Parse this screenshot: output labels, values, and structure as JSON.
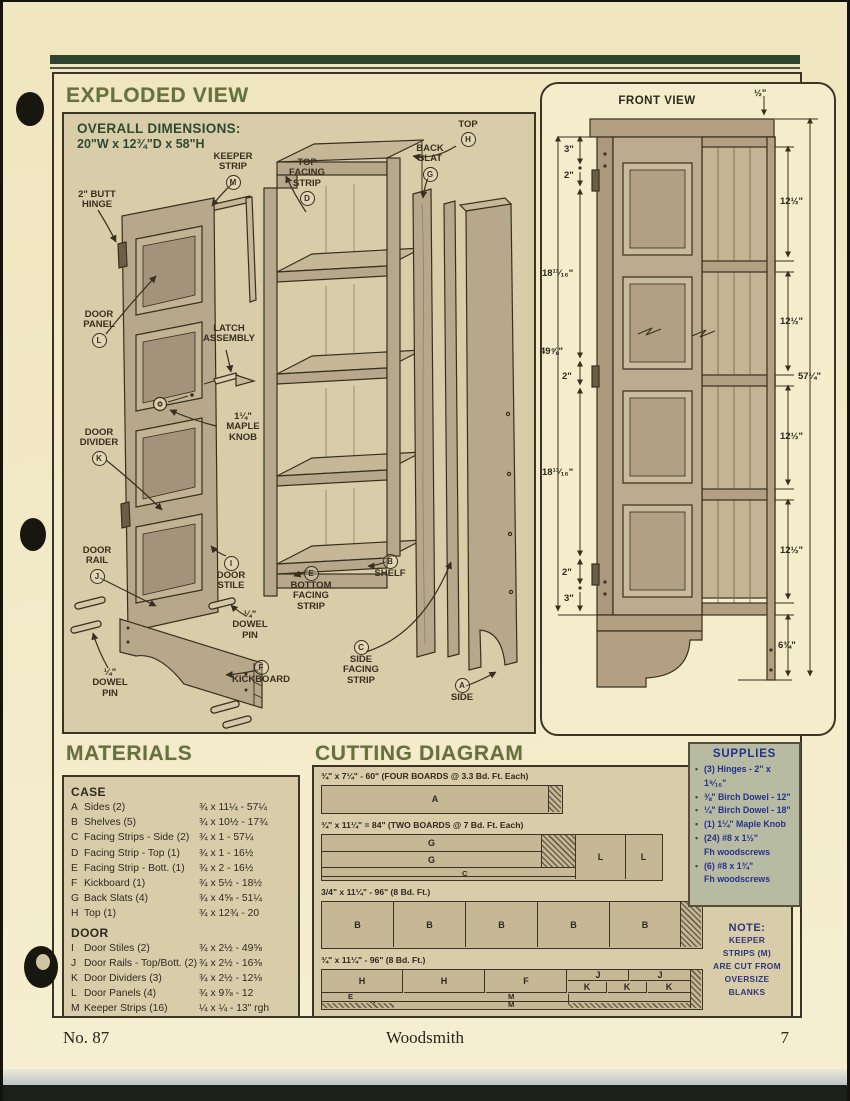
{
  "header": {
    "exploded_title": "EXPLODED VIEW"
  },
  "exploded": {
    "overall1": "OVERALL DIMENSIONS:",
    "overall2": "20\"W x 12¾\"D x 58\"H",
    "labels": [
      {
        "lines": [
          "TOP"
        ],
        "letter": "H",
        "lp": "below",
        "x": 376,
        "y": 6,
        "w": 56
      },
      {
        "lines": [
          "BACK",
          "SLAT"
        ],
        "letter": "G",
        "lp": "below",
        "x": 336,
        "y": 30,
        "w": 60
      },
      {
        "lines": [
          "KEEPER",
          "STRIP"
        ],
        "letter": "M",
        "lp": "below",
        "x": 134,
        "y": 38,
        "w": 70
      },
      {
        "lines": [
          "TOP",
          "FACING",
          "STRIP"
        ],
        "letter": "D",
        "lp": "below",
        "x": 210,
        "y": 44,
        "w": 66
      },
      {
        "lines": [
          "2\" BUTT",
          "HINGE"
        ],
        "x": 4,
        "y": 76,
        "w": 58
      },
      {
        "lines": [
          "DOOR",
          "PANEL"
        ],
        "letter": "L",
        "lp": "below",
        "x": 6,
        "y": 196,
        "w": 58
      },
      {
        "lines": [
          "LATCH",
          "ASSEMBLY"
        ],
        "x": 126,
        "y": 210,
        "w": 78
      },
      {
        "lines": [
          "1¼\"",
          "MAPLE",
          "KNOB"
        ],
        "x": 150,
        "y": 298,
        "w": 58
      },
      {
        "lines": [
          "DOOR",
          "DIVIDER"
        ],
        "letter": "K",
        "lp": "below",
        "x": 2,
        "y": 314,
        "w": 66
      },
      {
        "lines": [
          "DOOR",
          "RAIL"
        ],
        "letter": "J",
        "lp": "below",
        "x": 6,
        "y": 432,
        "w": 54
      },
      {
        "lines": [
          "DOOR",
          "STILE"
        ],
        "letter": "I",
        "lp": "above",
        "x": 138,
        "y": 440,
        "w": 58
      },
      {
        "lines": [
          "¼\"",
          "DOWEL",
          "PIN"
        ],
        "x": 160,
        "y": 496,
        "w": 52
      },
      {
        "lines": [
          "SHELF"
        ],
        "letter": "B",
        "lp": "above",
        "x": 298,
        "y": 438,
        "w": 56
      },
      {
        "lines": [
          "BOTTOM",
          "FACING",
          "STRIP"
        ],
        "letter": "E",
        "lp": "above",
        "x": 214,
        "y": 450,
        "w": 66
      },
      {
        "lines": [
          "KICKBOARD"
        ],
        "letter": "F",
        "lp": "above",
        "x": 152,
        "y": 544,
        "w": 90
      },
      {
        "lines": [
          "¼\"",
          "DOWEL",
          "PIN"
        ],
        "x": 20,
        "y": 554,
        "w": 52
      },
      {
        "lines": [
          "SIDE",
          "FACING",
          "STRIP"
        ],
        "letter": "C",
        "lp": "above",
        "x": 268,
        "y": 524,
        "w": 58
      },
      {
        "lines": [
          "SIDE"
        ],
        "letter": "A",
        "lp": "above",
        "x": 374,
        "y": 562,
        "w": 48
      }
    ]
  },
  "front_view": {
    "title": "FRONT VIEW",
    "dims": [
      {
        "t": "½\"",
        "x": 212,
        "y": 4
      },
      {
        "t": "3\"",
        "x": 22,
        "y": 60
      },
      {
        "t": "2\"",
        "x": 22,
        "y": 86
      },
      {
        "t": "18¹³⁄₁₆\"",
        "x": 0,
        "y": 184
      },
      {
        "t": "49⅝\"",
        "x": -2,
        "y": 262
      },
      {
        "t": "2\"",
        "x": 20,
        "y": 287
      },
      {
        "t": "18¹³⁄₁₆\"",
        "x": 0,
        "y": 383
      },
      {
        "t": "2\"",
        "x": 20,
        "y": 483
      },
      {
        "t": "3\"",
        "x": 22,
        "y": 509
      },
      {
        "t": "12½\"",
        "x": 238,
        "y": 112
      },
      {
        "t": "12½\"",
        "x": 238,
        "y": 232
      },
      {
        "t": "12½\"",
        "x": 238,
        "y": 347
      },
      {
        "t": "12½\"",
        "x": 238,
        "y": 461
      },
      {
        "t": "6¾\"",
        "x": 236,
        "y": 556
      },
      {
        "t": "57¼\"",
        "x": 256,
        "y": 287
      }
    ]
  },
  "materials": {
    "title": "MATERIALS",
    "case_header": "CASE",
    "door_header": "DOOR",
    "case_rows": [
      {
        "id": "A",
        "name": "Sides (2)",
        "dim": "¾ x 11¼ - 57¼"
      },
      {
        "id": "B",
        "name": "Shelves (5)",
        "dim": "¾ x 10½ - 17¾"
      },
      {
        "id": "C",
        "name": "Facing Strips - Side (2)",
        "dim": "¾ x 1 - 57¼"
      },
      {
        "id": "D",
        "name": "Facing Strip - Top (1)",
        "dim": "¾ x 1 - 16½"
      },
      {
        "id": "E",
        "name": "Facing Strip - Bott. (1)",
        "dim": "¾ x 2 - 16½"
      },
      {
        "id": "F",
        "name": "Kickboard (1)",
        "dim": "¾ x 5½ - 18½"
      },
      {
        "id": "G",
        "name": "Back Slats (4)",
        "dim": "¾ x 4⅝ - 51¼"
      },
      {
        "id": "H",
        "name": "Top (1)",
        "dim": "¾ x 12¾ - 20"
      }
    ],
    "door_rows": [
      {
        "id": "I",
        "name": "Door Stiles (2)",
        "dim": "¾ x 2½ - 49⅝"
      },
      {
        "id": "J",
        "name": "Door Rails - Top/Bott. (2)",
        "dim": "¾ x 2½ - 16⅜"
      },
      {
        "id": "K",
        "name": "Door Dividers (3)",
        "dim": "¾ x 2½ - 12⅛"
      },
      {
        "id": "L",
        "name": "Door Panels (4)",
        "dim": "¾ x 9⅞ - 12"
      },
      {
        "id": "M",
        "name": "Keeper Strips (16)",
        "dim": "¼ x ¼ - 13\" rgh"
      }
    ]
  },
  "cutting": {
    "title": "CUTTING DIAGRAM",
    "captions": {
      "b1": "¾\" x 7¼\" - 60\"  (FOUR BOARDS @ 3.3 Bd. Ft. Each)",
      "b2": "¾\" x 11¼\" = 84\"  (TWO BOARDS @ 7 Bd. Ft. Each)",
      "b3": "3/4\" x 11¼\" - 96\"  (8 Bd. Ft.)",
      "b4": "¾\" x 11¼\" - 96\"  (8 Bd. Ft.)"
    },
    "cells": {
      "b1": [
        "A"
      ],
      "b2": [
        "G",
        "G",
        "C",
        "L",
        "L"
      ],
      "b3": [
        "B",
        "B",
        "B",
        "B",
        "B"
      ],
      "b4": [
        "H",
        "H",
        "F",
        "J",
        "J",
        "K",
        "K",
        "K",
        "E",
        "D",
        "M",
        "M"
      ]
    }
  },
  "supplies": {
    "title": "SUPPLIES",
    "items": [
      {
        "b": 1,
        "t": "(3) Hinges - 2\" x 1⁹⁄₁₆\""
      },
      {
        "b": 1,
        "t": "⅜\" Birch Dowel - 12\""
      },
      {
        "b": 1,
        "t": "¼\" Birch Dowel - 18\""
      },
      {
        "b": 1,
        "t": "(1) 1¼\" Maple Knob"
      },
      {
        "b": 1,
        "t": "(24) #8 x 1½\""
      },
      {
        "b": 0,
        "t": "Fh woodscrews"
      },
      {
        "b": 1,
        "t": "(6) #8 x 1¾\""
      },
      {
        "b": 0,
        "t": "Fh woodscrews"
      }
    ]
  },
  "note": {
    "title": "NOTE:",
    "body": "KEEPER\nSTRIPS  (M)\nARE CUT FROM\nOVERSIZE\nBLANKS"
  },
  "footer": {
    "left": "No. 87",
    "center": "Woodsmith",
    "right": "7"
  }
}
